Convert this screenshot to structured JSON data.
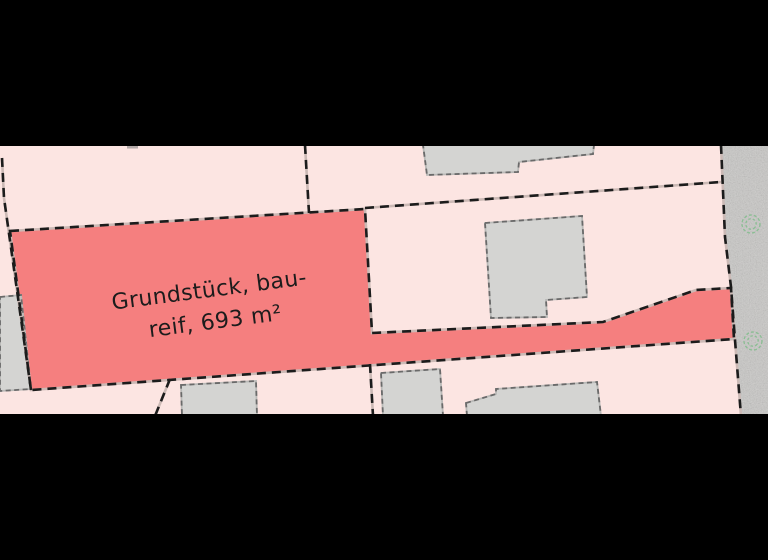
{
  "map": {
    "highlighted_parcel": {
      "label_line1": "Grundstück, bau-",
      "label_line2": "reif, 693 m²"
    },
    "colors": {
      "letterbox": "#000000",
      "parcel_fill": "#fce5e2",
      "highlight_fill": "#f57f7f",
      "boundary_dash": "#1c1c1c",
      "boundary_gap": "#cbb9b5",
      "building_fill": "#d4d4d2",
      "building_outline": "#6a6a6a",
      "building_outline_gap": "#b9b9b7",
      "road_surface": "#c9c8c6",
      "tree": "#7fbd8a",
      "label_text": "#1c1c1c"
    },
    "icons": {
      "tree_icon": "dashed green scribble circle"
    }
  }
}
